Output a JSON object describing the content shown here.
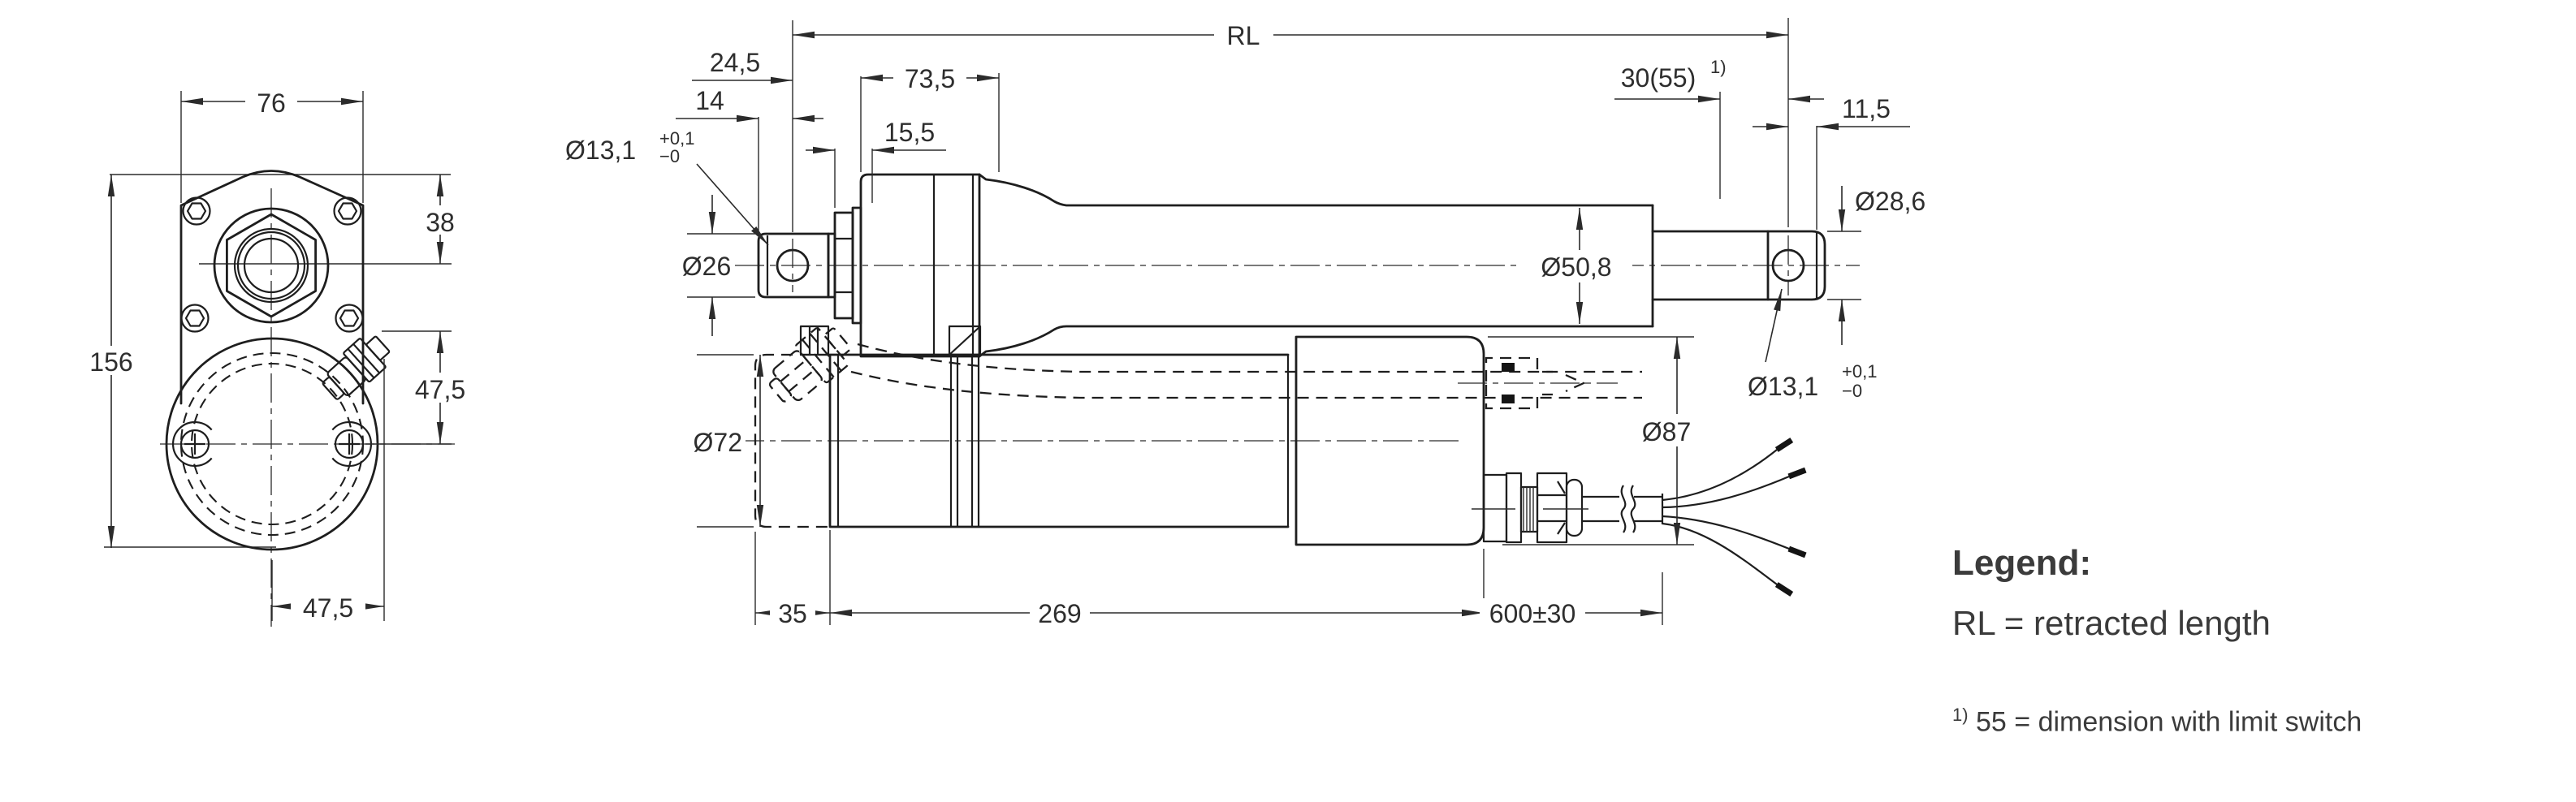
{
  "dims": {
    "w76": "76",
    "h38": "38",
    "h156": "156",
    "c47_5": "47,5",
    "b47_5": "47,5",
    "rl": "RL",
    "d24_5": "24,5",
    "d14": "14",
    "d73_5": "73,5",
    "d15_5": "15,5",
    "d30_55": "30(55)",
    "sup": "1)",
    "d11_5": "11,5",
    "dia13": "Ø13,1",
    "tol_plus": "+0,1",
    "tol_minus": "−0",
    "dia26": "Ø26",
    "dia50_8": "Ø50,8",
    "dia28_6": "Ø28,6",
    "dia72": "Ø72",
    "dia87": "Ø87",
    "d35": "35",
    "d269": "269",
    "d600": "600±30"
  },
  "legend": {
    "title": "Legend:",
    "rl_definition": "RL = retracted length",
    "foot_sup": "1)",
    "footnote": "55 = dimension with limit switch"
  },
  "colors": {
    "line": "#1e1e1e",
    "text": "#3b3b3b",
    "background": "#ffffff"
  }
}
